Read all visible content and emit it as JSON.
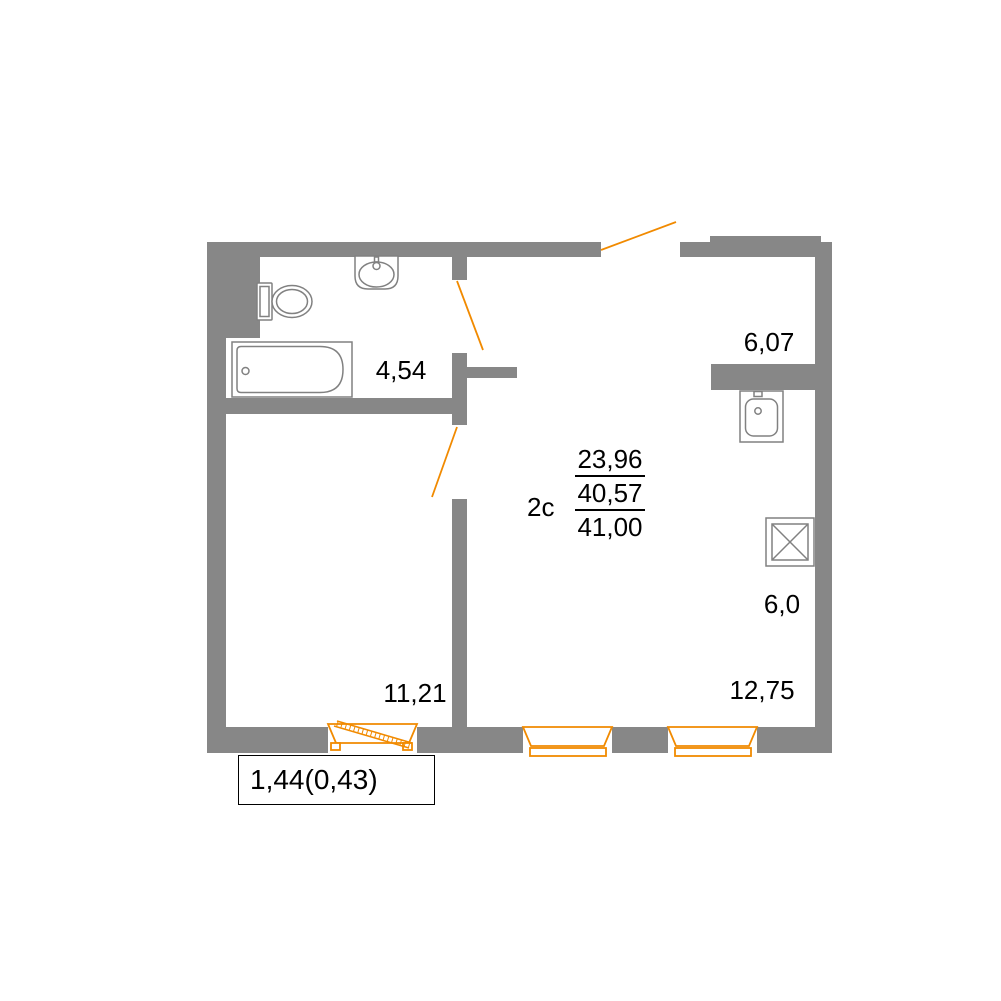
{
  "floor_plan": {
    "unit_type": "2c",
    "area_summary": {
      "living": "23,96",
      "without_balcony": "40,57",
      "total": "41,00"
    },
    "room_areas": {
      "bathroom": "4,54",
      "room": "11,21",
      "upper_right": "6,07",
      "kitchen": "6,0",
      "living_room": "12,75"
    },
    "balcony_area": "1,44(0,43)",
    "fixtures": [
      "toilet",
      "sink",
      "bathtub",
      "kitchen-sink",
      "stove-vent"
    ]
  },
  "colors": {
    "wall": "#878787",
    "accent_orange": "#F18A00",
    "fixture": "#818181",
    "text": "#000000"
  }
}
